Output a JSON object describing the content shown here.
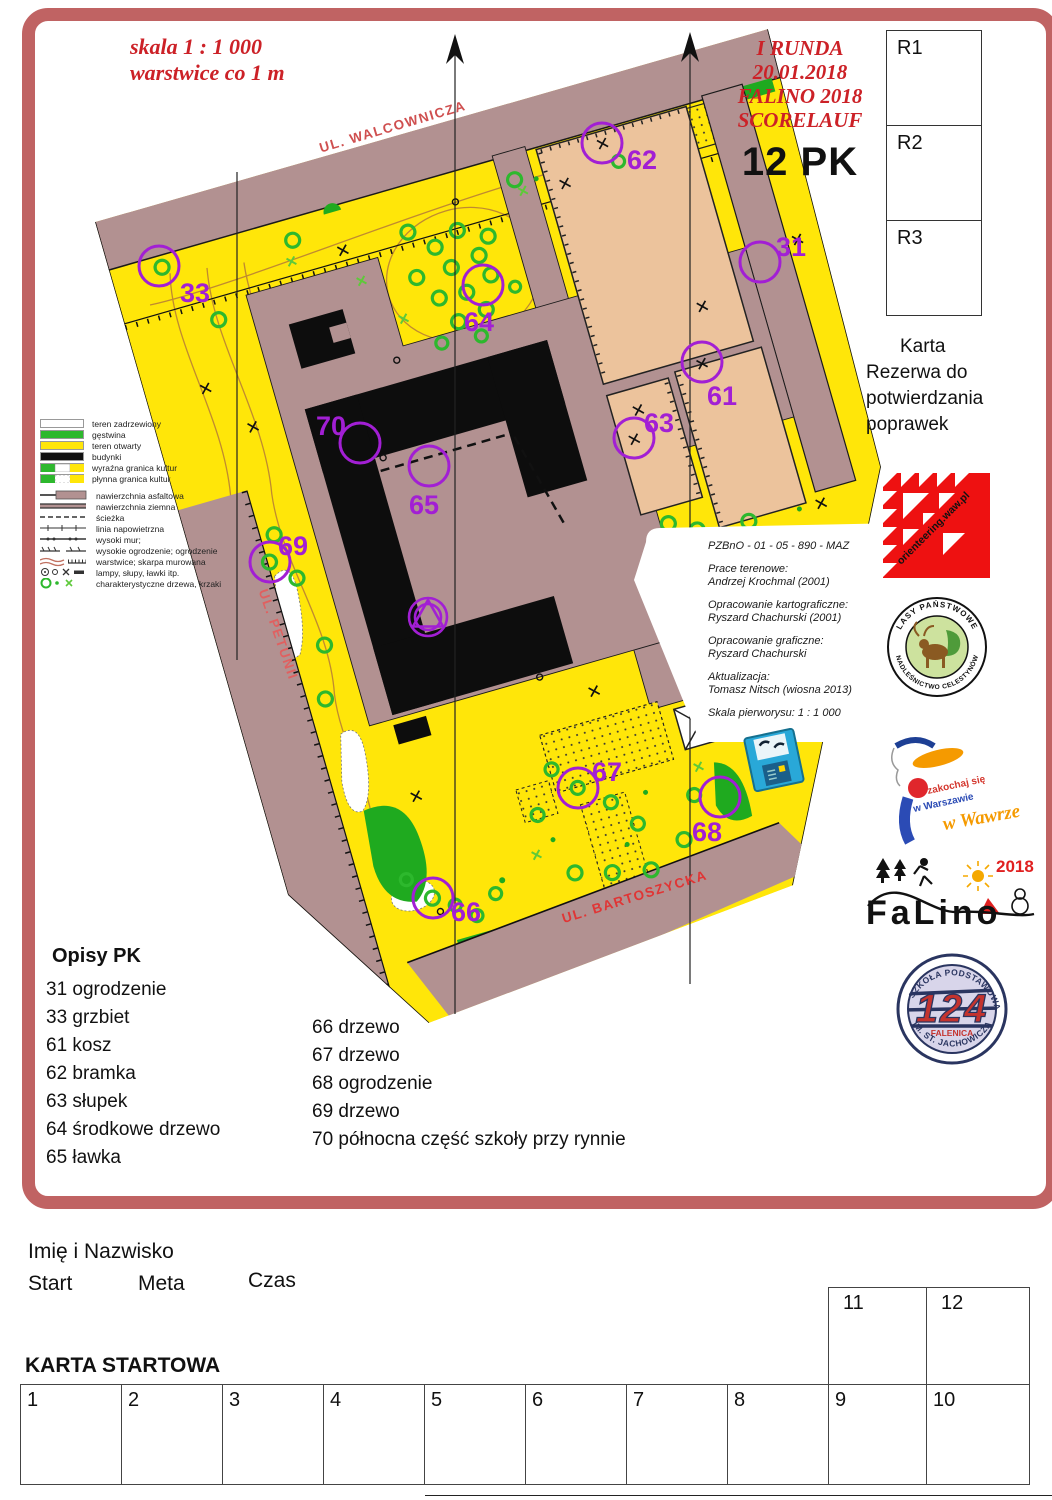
{
  "header": {
    "scale_line1": "skala 1 : 1 000",
    "scale_line2": "warstwice co 1 m",
    "event_lines": [
      "I RUNDA",
      "20.01.2018",
      "FALINO 2018",
      "SCORELAUF"
    ],
    "points_label": "12 PK",
    "reserve_boxes": [
      "R1",
      "R2",
      "R3"
    ],
    "reserve_caption_lines": [
      "Karta",
      "Rezerwa do",
      "potwierdzania",
      "poprawek"
    ]
  },
  "map": {
    "streets": [
      {
        "name": "UL. WALCOWNICZA",
        "x": 394,
        "y": 131,
        "rot": -16.5,
        "color": "#cf4f4f"
      },
      {
        "name": "UL. PETUNII",
        "x": 274,
        "y": 636,
        "rot": 71,
        "color": "#e06060"
      },
      {
        "name": "UL. BARTOSZYCKA",
        "x": 636,
        "y": 901,
        "rot": -17,
        "color": "#e03535"
      }
    ],
    "controls": [
      {
        "num": "31",
        "cx": 760,
        "cy": 262,
        "lx": 791,
        "ly": 247
      },
      {
        "num": "33",
        "cx": 159,
        "cy": 266,
        "lx": 195,
        "ly": 293
      },
      {
        "num": "61",
        "cx": 702,
        "cy": 362,
        "lx": 722,
        "ly": 396
      },
      {
        "num": "62",
        "cx": 602,
        "cy": 143,
        "lx": 642,
        "ly": 160
      },
      {
        "num": "63",
        "cx": 634,
        "cy": 438,
        "lx": 659,
        "ly": 423
      },
      {
        "num": "64",
        "cx": 483,
        "cy": 285,
        "lx": 479,
        "ly": 322
      },
      {
        "num": "65",
        "cx": 429,
        "cy": 466,
        "lx": 424,
        "ly": 505
      },
      {
        "num": "66",
        "cx": 433,
        "cy": 898,
        "lx": 466,
        "ly": 912
      },
      {
        "num": "67",
        "cx": 578,
        "cy": 788,
        "lx": 607,
        "ly": 772
      },
      {
        "num": "68",
        "cx": 720,
        "cy": 797,
        "lx": 707,
        "ly": 832
      },
      {
        "num": "69",
        "cx": 270,
        "cy": 562,
        "lx": 293,
        "ly": 546
      },
      {
        "num": "70",
        "cx": 360,
        "cy": 443,
        "lx": 331,
        "ly": 426
      }
    ],
    "north_lines": [
      {
        "x": 237,
        "y1": 172,
        "y2": 660,
        "arrow": false
      },
      {
        "x": 455,
        "y1": 34,
        "y2": 1014,
        "arrow": true
      },
      {
        "x": 690,
        "y1": 32,
        "y2": 984,
        "arrow": true
      }
    ]
  },
  "legend": {
    "area_rows": [
      "teren zadrzewiony",
      "gęstwina",
      "teren otwarty",
      "budynki",
      "wyraźna granica kultur",
      "płynna granica kultur"
    ],
    "symbol_rows": [
      "nawierzchnia asfaltowa",
      "nawierzchnia ziemna",
      "ścieżka",
      "linia napowietrzna",
      "wysoki mur;",
      "wysokie ogrodzenie; ogrodzenie",
      "warstwice; skarpa murowana",
      "lampy, słupy, ławki itp.",
      "charakterystyczne drzewa, krzaki"
    ]
  },
  "credits": {
    "lines": [
      "PZBnO - 01 - 05 - 890 - MAZ",
      "",
      "Prace terenowe:",
      "Andrzej Krochmal (2001)",
      "",
      "Opracowanie kartograficzne:",
      "Ryszard Chachurski (2001)",
      "",
      "Opracowanie graficzne:",
      "Ryszard Chachurski",
      "",
      "Aktualizacja:",
      "Tomasz Nitsch (wiosna 2013)",
      "",
      "Skala pierworysu: 1 : 1 000"
    ]
  },
  "descriptions": {
    "title": "Opisy PK",
    "col1": [
      "31 ogrodzenie",
      "33 grzbiet",
      "61 kosz",
      "62 bramka",
      "63 słupek",
      "64 środkowe drzewo",
      "65 ławka"
    ],
    "col2": [
      "66 drzewo",
      "67 drzewo",
      "68 ogrodzenie",
      "69 drzewo",
      "70 północna część szkoły przy rynnie"
    ]
  },
  "logos": {
    "orienteering_text": "orienteering.waw.pl",
    "forest_top": "LASY PAŃSTWOWE",
    "forest_bottom": "NADLEŚNICTWO CELESTYNÓW",
    "warsaw_line1": "zakochaj się",
    "warsaw_line2": "w Warszawie",
    "warsaw_line3": "w Wawrze",
    "falino_name": "FaLino",
    "falino_year": "2018",
    "school_top": "SZKOŁA PODSTAWOWA",
    "school_num": "124",
    "school_mid": "FALENICA",
    "school_bottom": "IM. ST. JACHOWICZA"
  },
  "footer": {
    "name_label": "Imię i Nazwisko",
    "start_label": "Start",
    "meta_label": "Meta",
    "czas_label": "Czas",
    "card_title": "KARTA STARTOWA",
    "cells_row": [
      "1",
      "2",
      "3",
      "4",
      "5",
      "6",
      "7",
      "8",
      "9",
      "10"
    ],
    "cells_upper": [
      "11",
      "12"
    ]
  }
}
